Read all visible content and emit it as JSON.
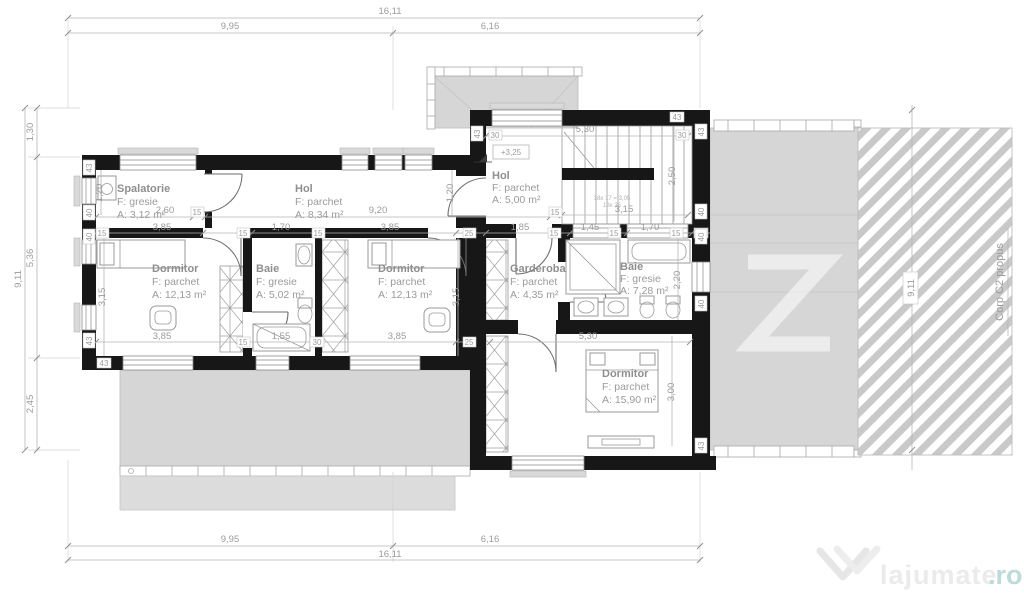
{
  "annotations": {
    "level_marker": "+3,25",
    "corp_label": "Corp C2 propus",
    "stair_note": "18x 17 = 3,05",
    "stair_note2": "18x 25"
  },
  "watermark": {
    "brand": "lajumate",
    "tld": ".ro",
    "logo": "double-chevron-heart"
  },
  "colors": {
    "wall": "#171717",
    "gray_fill": "#d6d6d6",
    "hatch": "#c9c9c9",
    "watermark_teal": "#bedbdb"
  },
  "rooms": [
    {
      "name": "Spalatorie",
      "floor": "F: gresie",
      "area": "A: 3,12 m²"
    },
    {
      "name": "Hol",
      "floor": "F: parchet",
      "area": "A: 8,34 m²"
    },
    {
      "name": "Hol",
      "floor": "F: parchet",
      "area": "A: 5,00 m²"
    },
    {
      "name": "Dormitor",
      "floor": "F: parchet",
      "area": "A: 12,13 m²"
    },
    {
      "name": "Baie",
      "floor": "F: gresie",
      "area": "A: 5,02 m²"
    },
    {
      "name": "Dormitor",
      "floor": "F: parchet",
      "area": "A: 12,13 m²"
    },
    {
      "name": "Garderoba",
      "floor": "F: parchet",
      "area": "A: 4,35 m²"
    },
    {
      "name": "Baie",
      "floor": "F: gresie",
      "area": "A: 7,28 m²"
    },
    {
      "name": "Dormitor",
      "floor": "F: parchet",
      "area": "A: 15,90 m²"
    }
  ],
  "dims": {
    "t_total": "16,11",
    "t_seg1": "9,95",
    "t_seg2": "6,16",
    "l_total": "9,11",
    "l_s1": "1,30",
    "l_s2": "5,36",
    "l_s3": "2,45",
    "r_total": "9,11",
    "v15": "15",
    "v25": "25",
    "v30": "30",
    "v40": "40",
    "v43": "43",
    "sp_w": "2,60",
    "sp_parapet": "1,20",
    "hol_w": "9,20",
    "hol_h": "1,20",
    "stair_w": "5,30",
    "stair_h": "2,50",
    "stair_b": "3,15",
    "d1_w": "3,85",
    "d1_h": "3,15",
    "d1_bw": "3,85",
    "b1_w": "1,70",
    "b1_bw": "1,55",
    "d2_w": "3,85",
    "d2_h": "3,15",
    "d2_bw": "3,85",
    "g_w": "1,85",
    "b2_w1": "1,45",
    "b2_w2": "1,70",
    "b2_h": "2,20",
    "d3_w": "5,30",
    "d3_h": "3,00"
  }
}
